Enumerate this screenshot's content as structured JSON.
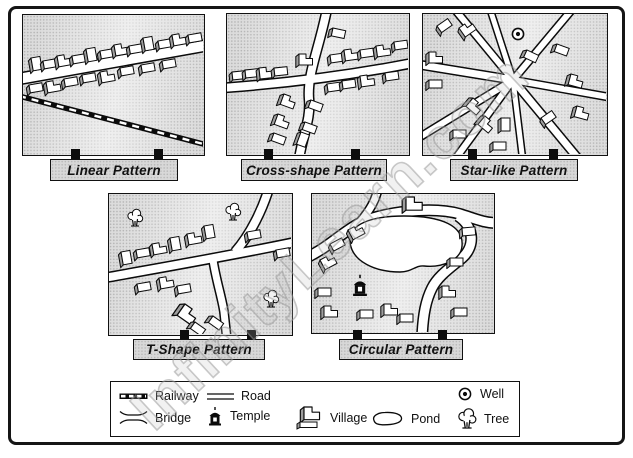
{
  "watermark": {
    "text": "InfinityLearn.com"
  },
  "panels": [
    {
      "id": "linear",
      "label": "Linear Pattern"
    },
    {
      "id": "cross",
      "label": "Cross-shape Pattern"
    },
    {
      "id": "star",
      "label": "Star-like Pattern"
    },
    {
      "id": "t-shape",
      "label": "T-Shape Pattern"
    },
    {
      "id": "circular",
      "label": "Circular Pattern"
    }
  ],
  "legend": {
    "items": [
      {
        "icon": "railway-icon",
        "label": "Railway"
      },
      {
        "icon": "road-icon",
        "label": "Road"
      },
      {
        "icon": "well-icon",
        "label": "Well"
      },
      {
        "icon": "bridge-icon",
        "label": "Bridge"
      },
      {
        "icon": "temple-icon",
        "label": "Temple"
      },
      {
        "icon": "village-icon",
        "label": "Village"
      },
      {
        "icon": "pond-icon",
        "label": "Pond"
      },
      {
        "icon": "tree-icon",
        "label": "Tree"
      }
    ]
  },
  "colors": {
    "panel_bg": "#dcdcdc",
    "panel_dot": "#b5b5b5",
    "label_bg": "#d8d8d8",
    "ink": "#111111",
    "building_side": "#9e9e9e",
    "watermark_gray": "#bebebe"
  }
}
